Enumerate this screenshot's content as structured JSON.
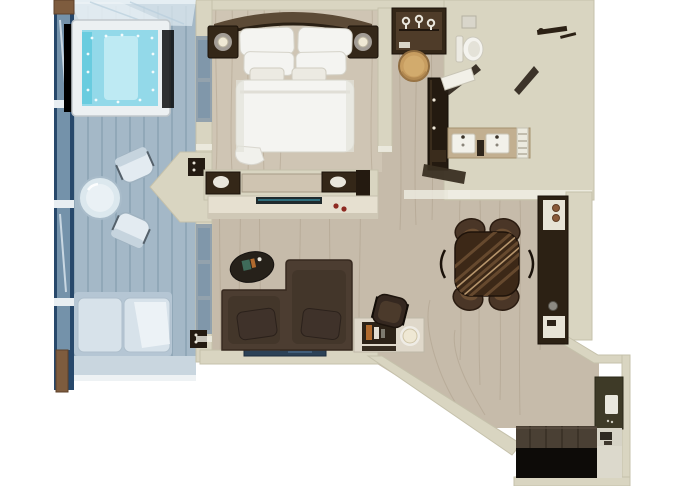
{
  "scene": {
    "type": "3d-floor-plan",
    "view": "top-down-render",
    "setting": "suite-with-private-balcony",
    "rooms": [
      "balcony",
      "bedroom",
      "wardrobe-corridor",
      "bathroom",
      "living-room",
      "dining-area",
      "entry-hall"
    ],
    "furniture": {
      "balcony": [
        "hot-tub",
        "bistro-table",
        "bistro-chair",
        "lounge-sofa",
        "glass-railing",
        "wood-deck",
        "glass-canopy"
      ],
      "bedroom": [
        "king-bed",
        "curved-headboard",
        "nightstand",
        "bedside-lamp",
        "dresser-console"
      ],
      "wardrobe-corridor": [
        "closet-with-hangers",
        "vanity-stool",
        "tall-cabinet"
      ],
      "bathroom": [
        "toilet",
        "cistern-shelf",
        "glass-door",
        "walk-in-shower",
        "double-vanity-sinks",
        "towel-ladder"
      ],
      "living-room": [
        "tv-console",
        "oval-coffee-table",
        "two-seat-sofa",
        "wall-art",
        "writing-desk",
        "desk-chair",
        "desk-lamp"
      ],
      "dining-area": [
        "round-dining-table",
        "dining-chair",
        "bar-cabinet"
      ],
      "entry-hall": [
        "entry-closet",
        "door-plate",
        "entry-shelf",
        "dark-threshold",
        "door-mat"
      ]
    }
  },
  "palette": {
    "bg": "#ffffff",
    "wall": "#d9d5c1",
    "wallEdge": "#c5c1ab",
    "wallCap": "#efede3",
    "wood": "#c6bbaa",
    "woodGrain": "#a2937f",
    "bedFloor": "#cfc5b4",
    "tile": "#b3a185",
    "tileDark": "#a89576",
    "tileLine": "#8d7b60",
    "deck": "#a4b8c7",
    "deckLine": "#8099ab",
    "deckLight": "#c9d6df",
    "railBlue": "#27486b",
    "railGlass": "#8aa6bc",
    "post": "#7e5c3e",
    "tubFrame": "#ecf0f2",
    "tubWater": "#93d9e9",
    "tubWaterLight": "#c6ecf4",
    "seatTeal": "#5fc8dc",
    "white": "#f4f3ee",
    "linen": "#f4f4f1",
    "linenShadow": "#d5d3c9",
    "darkWood": "#342718",
    "midWood": "#4f3c29",
    "headboard": "#5c4a36",
    "sofa": "#4c3d31",
    "sofaDark": "#37291f",
    "cushion": "#3f322a",
    "tableWood": "#3c2817",
    "tableStripe": "#6e4f33",
    "tableStripeLight": "#c4a176",
    "chair": "#4a3627",
    "chairLight": "#6b4e33",
    "stool": "#c79d60",
    "stoolDark": "#8f6c3f",
    "lamp": "#efe8d4",
    "marble": "#dfd8ca",
    "book": "#2c2217",
    "bookOrange": "#b06a2e",
    "tvDark": "#1f2a2d",
    "tvTeal": "#2f6e7c",
    "accentRed": "#8e2a22",
    "blueArt": "#2c4257",
    "olive": "#3e3a27",
    "entryFloor": "#4a4034",
    "mat": "#0d0b08",
    "frameGray": "#93a2ad",
    "glassBlue": "#7c95a9",
    "bistro": "#e3ebf1",
    "bistroEdge": "#9fb2c0"
  }
}
